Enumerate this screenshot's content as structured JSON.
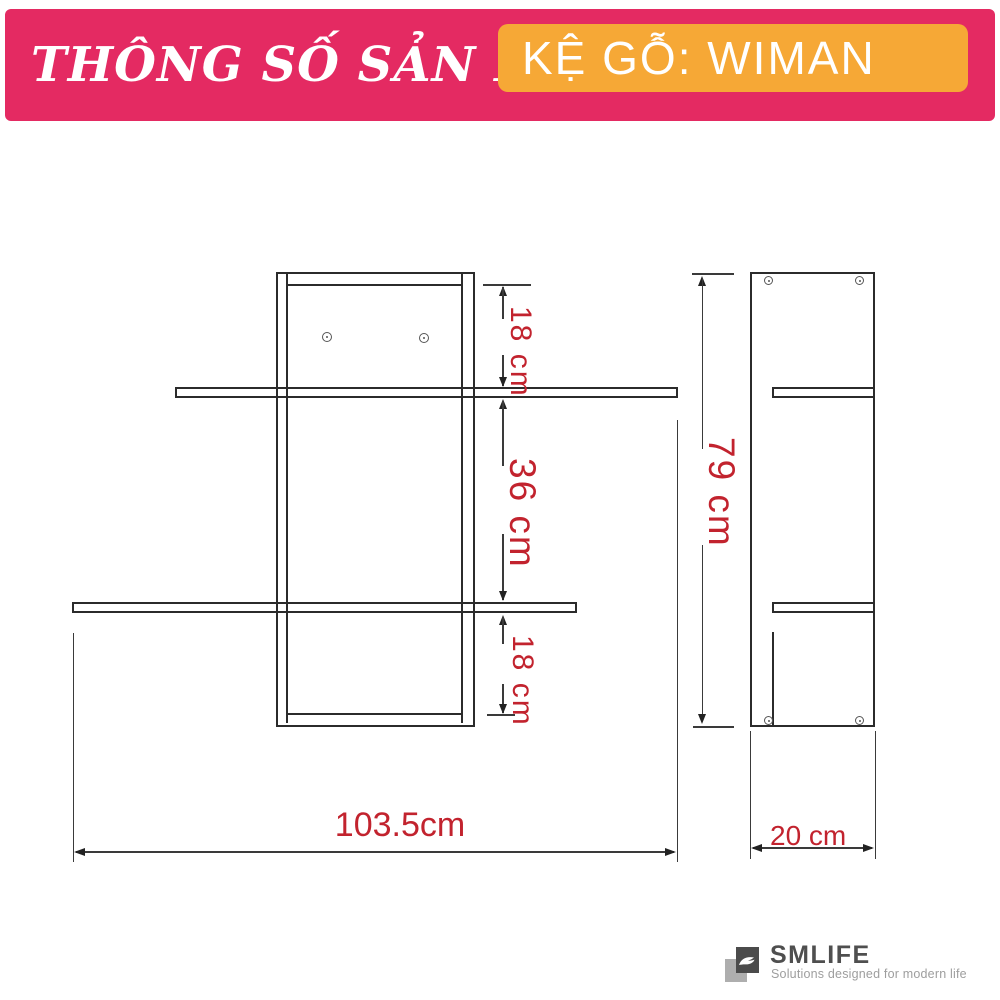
{
  "header": {
    "title": "THÔNG SỐ SẢN PHẨM",
    "product": "KỆ GỖ: WIMAN"
  },
  "dimensions": {
    "top_section": "18 cm",
    "middle_section": "36 cm",
    "bottom_section": "18 cm",
    "height": "79 cm",
    "width": "103.5cm",
    "depth": "20 cm"
  },
  "footer": {
    "brand": "SMLIFE",
    "tagline": "Solutions designed for modern life"
  },
  "colors": {
    "header_bg": "#E42A62",
    "badge_bg": "#F6A836",
    "dimension_text": "#C2232E",
    "drawing_line": "#2B2B2B"
  }
}
